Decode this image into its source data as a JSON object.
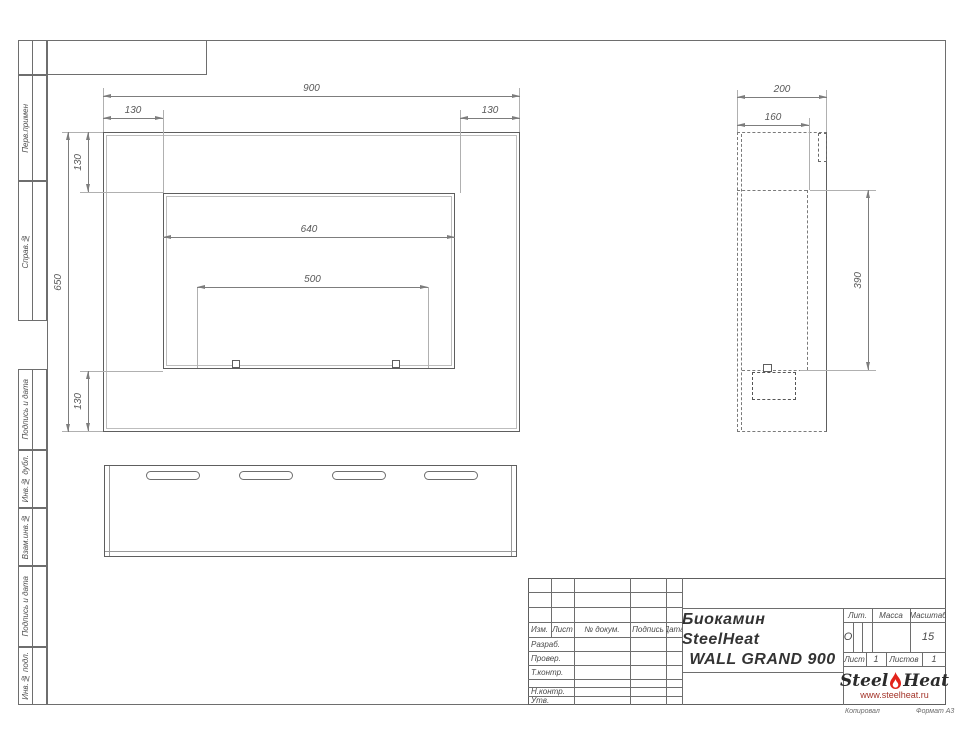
{
  "sheet": {
    "side_strip_top": [
      {
        "label": "Перв.примен"
      },
      {
        "label": "Справ.№"
      }
    ],
    "side_strip_bottom": [
      {
        "label": "Подпись и дата"
      },
      {
        "label": "Инв.№ дубл."
      },
      {
        "label": "Взам.инв.№"
      },
      {
        "label": "Подпись и дата"
      },
      {
        "label": "Инв.№ подл."
      }
    ]
  },
  "dims": {
    "front_width": "900",
    "front_left_offset": "130",
    "front_right_offset": "130",
    "front_height": "650",
    "front_top_offset": "130",
    "front_bottom_offset": "130",
    "opening_width": "640",
    "burner_width": "500",
    "side_depth": "200",
    "side_inner_depth": "160",
    "side_opening_height": "390"
  },
  "title_block": {
    "header": [
      "Изм.",
      "Лист",
      "№ докум.",
      "Подпись",
      "Дата"
    ],
    "rows": [
      "Разраб.",
      "Провер.",
      "Т.контр.",
      "Н.контр.",
      "Утв."
    ],
    "product_line1": "Биокамин SteelHeat",
    "product_line2": "WALL GRAND 900",
    "lit_label": "Лит.",
    "lit_value": "О",
    "mass_label": "Масса",
    "scale_label": "Масштаб",
    "scale_value": "15",
    "sheet_label": "Лист",
    "sheet_value": "1",
    "sheets_label": "Листов",
    "sheets_value": "1",
    "logo_steel": "Steel",
    "logo_heat": "Heat",
    "logo_url": "www.steelheat.ru",
    "footer_copy": "Копировал",
    "footer_format": "Формат А3",
    "accent_red": "#e2231a"
  }
}
